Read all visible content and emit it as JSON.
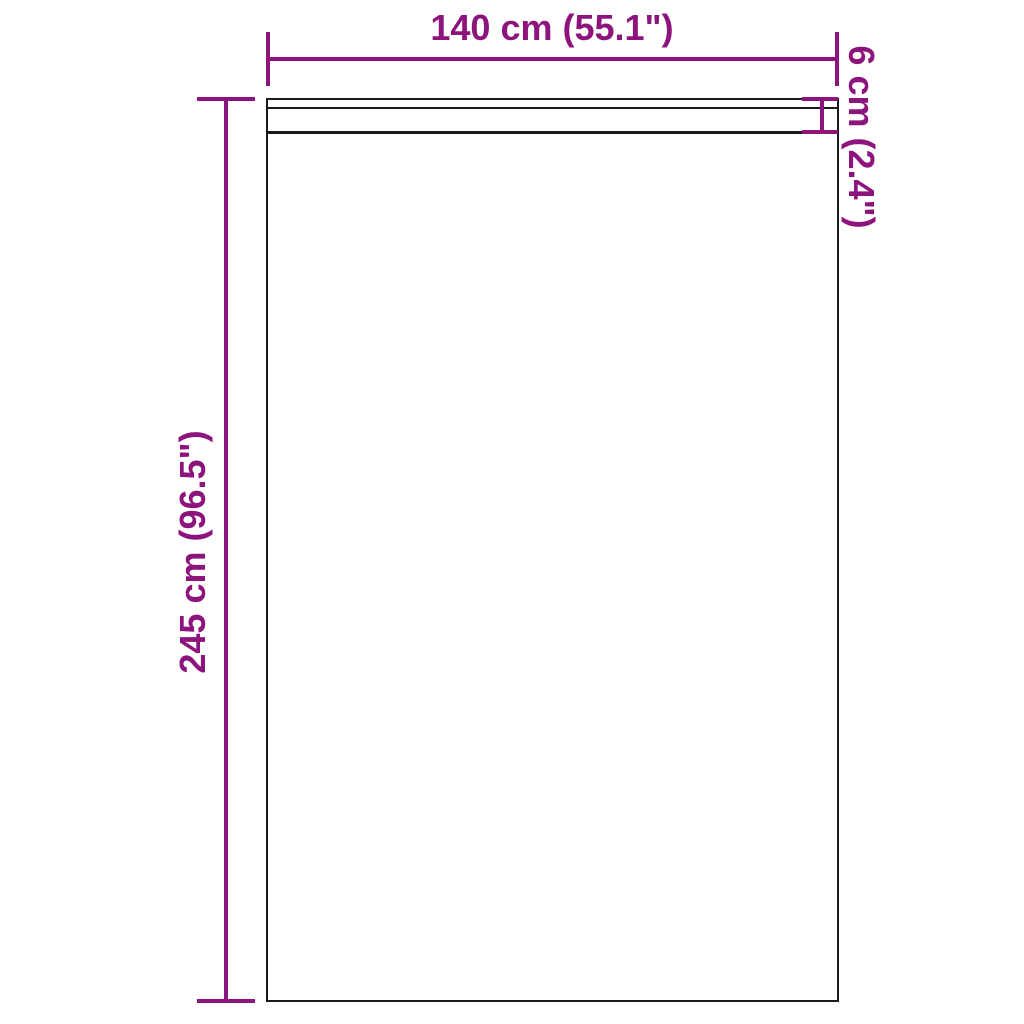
{
  "diagram": {
    "type": "product-dimension-diagram",
    "subject": "curtain panel with header band",
    "background_color": "#ffffff",
    "accent_color": "#8E147D",
    "outline_color": "#1a1a1a",
    "dimensions": {
      "width": {
        "label": "140 cm (55.1\")"
      },
      "height": {
        "label": "245 cm (96.5\")"
      },
      "header_band": {
        "label": "6 cm (2.4\")"
      }
    }
  }
}
